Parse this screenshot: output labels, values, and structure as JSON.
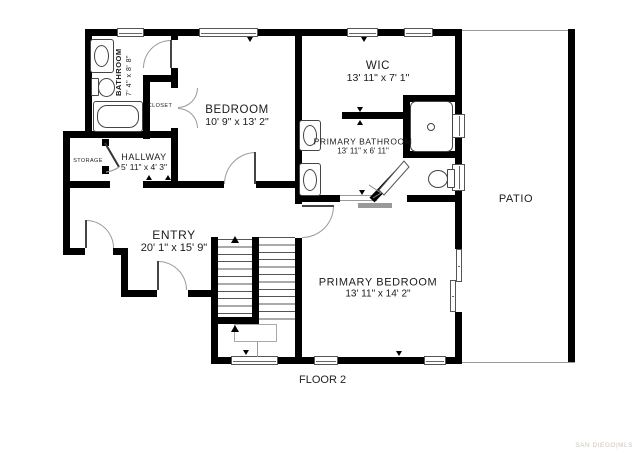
{
  "plan": {
    "floor_label": "FLOOR 2",
    "watermark": "SAN DIEGO|MLS",
    "rooms": {
      "bathroom": {
        "name": "BATHROOM",
        "dims": "7' 4\" x 8' 8\""
      },
      "closet": {
        "name": "CLOSET"
      },
      "bedroom": {
        "name": "BEDROOM",
        "dims": "10' 9\" x 13' 2\""
      },
      "wic": {
        "name": "WIC",
        "dims": "13' 11\" x 7' 1\""
      },
      "primary_bathroom": {
        "name": "PRIMARY BATHROOM",
        "dims": "13' 11\" x 6' 11\""
      },
      "hallway": {
        "name": "HALLWAY",
        "dims": "5' 11\" x 4' 3\""
      },
      "storage": {
        "name": "STORAGE"
      },
      "entry": {
        "name": "ENTRY",
        "dims": "20' 1\" x 15' 9\""
      },
      "primary_bedroom": {
        "name": "PRIMARY BEDROOM",
        "dims": "13' 11\" x 14' 2\""
      },
      "patio": {
        "name": "PATIO"
      }
    },
    "colors": {
      "wall": "#000000",
      "fixture": "#444444",
      "window_frame": "#555555",
      "door_arc": "#9a9a9a",
      "watermark": "#cdc6be"
    }
  }
}
